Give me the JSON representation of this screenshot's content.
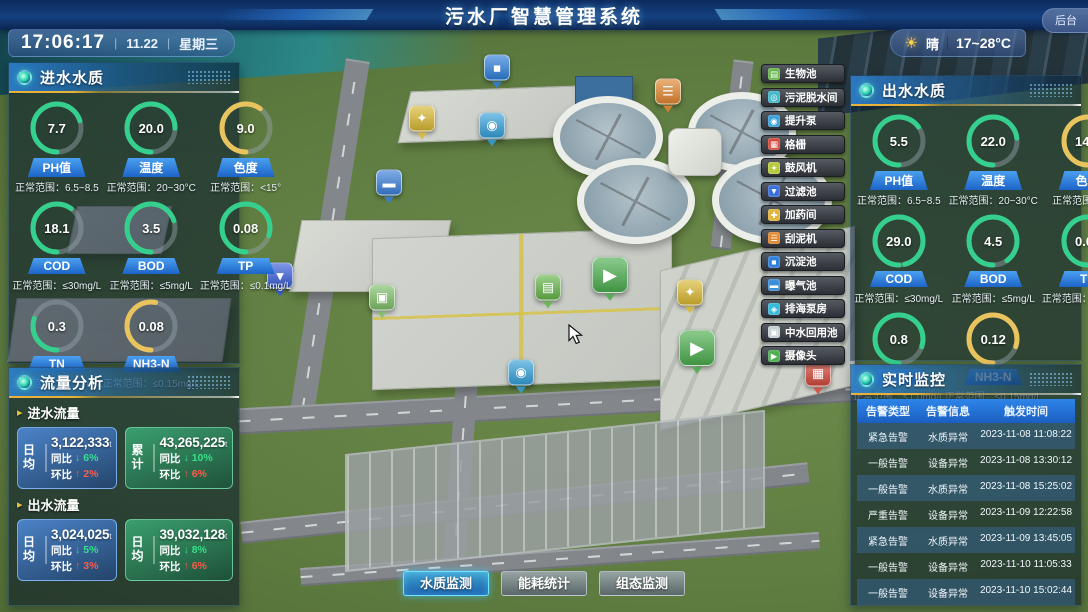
{
  "colors": {
    "green": "#35d08e",
    "yellow": "#e9c45e",
    "gauge_track": "rgba(154,163,173,0.45)",
    "accent_blue": "#2f86d9",
    "header_yellow": "#e8b23a",
    "trend_up_red": "#ff5a4a",
    "trend_down_green": "#35e08a"
  },
  "header": {
    "title": "污水厂智慧管理系统",
    "backstage": "后台"
  },
  "status_bar": {
    "time": "17:06:17",
    "date": "11.22",
    "weekday": "星期三",
    "weather_icon": "☀",
    "weather": "晴",
    "temp_range": "17~28°C"
  },
  "inlet_quality": {
    "title": "进水水质",
    "gauges": [
      {
        "label": "PH值",
        "value": "7.7",
        "range": "正常范围：6.5~8.5",
        "color": "green",
        "frac": 0.7
      },
      {
        "label": "温度",
        "value": "20.0",
        "range": "正常范围：20~30°C",
        "color": "green",
        "frac": 0.75
      },
      {
        "label": "色度",
        "value": "9.0",
        "range": "正常范围：<15°",
        "color": "yellow",
        "frac": 0.6
      },
      {
        "label": "COD",
        "value": "18.1",
        "range": "正常范围：≤30mg/L",
        "color": "green",
        "frac": 0.6
      },
      {
        "label": "BOD",
        "value": "3.5",
        "range": "正常范围：≤5mg/L",
        "color": "green",
        "frac": 0.7
      },
      {
        "label": "TP",
        "value": "0.08",
        "range": "正常范围：≤0.1mg/L",
        "color": "green",
        "frac": 0.8
      },
      {
        "label": "TN",
        "value": "0.3",
        "range": "正常范围：≤1.0mg/L",
        "color": "green",
        "frac": 0.3
      },
      {
        "label": "NH3-N",
        "value": "0.08",
        "range": "正常范围：≤0.15mg/L",
        "color": "yellow",
        "frac": 0.53
      }
    ]
  },
  "outlet_quality": {
    "title": "出水水质",
    "gauges": [
      {
        "label": "PH值",
        "value": "5.5",
        "range": "正常范围：6.5~8.5",
        "color": "green",
        "frac": 0.65
      },
      {
        "label": "温度",
        "value": "22.0",
        "range": "正常范围：20~30°C",
        "color": "green",
        "frac": 0.73
      },
      {
        "label": "色度",
        "value": "14.0",
        "range": "正常范围：<15°",
        "color": "yellow",
        "frac": 0.93
      },
      {
        "label": "COD",
        "value": "29.0",
        "range": "正常范围：≤30mg/L",
        "color": "green",
        "frac": 0.96
      },
      {
        "label": "BOD",
        "value": "4.5",
        "range": "正常范围：≤5mg/L",
        "color": "green",
        "frac": 0.9
      },
      {
        "label": "TP",
        "value": "0.07",
        "range": "正常范围：≤0.1mg/L",
        "color": "green",
        "frac": 0.7
      },
      {
        "label": "TN",
        "value": "0.8",
        "range": "正常范围：≤1.0mg/L",
        "color": "green",
        "frac": 0.8
      },
      {
        "label": "NH3-N",
        "value": "0.12",
        "range": "正常范围：≤0.15mg/L",
        "color": "yellow",
        "frac": 0.8
      }
    ]
  },
  "flow": {
    "title": "流量分析",
    "yoy_label": "同比",
    "mom_label": "环比",
    "down_arrow": "↓",
    "up_arrow": "↑",
    "unit": "t",
    "sections": [
      {
        "label": "进水流量",
        "cards": [
          {
            "tag": "日均",
            "value": "3,122,333",
            "yoy": "6%",
            "mom": "2%",
            "theme": "blue"
          },
          {
            "tag": "累计",
            "value": "43,265,225",
            "yoy": "10%",
            "mom": "6%",
            "theme": "green"
          }
        ]
      },
      {
        "label": "出水流量",
        "cards": [
          {
            "tag": "日均",
            "value": "3,024,025",
            "yoy": "5%",
            "mom": "3%",
            "theme": "blue"
          },
          {
            "tag": "日均",
            "value": "39,032,128",
            "yoy": "8%",
            "mom": "6%",
            "theme": "green"
          }
        ]
      }
    ]
  },
  "monitor": {
    "title": "实时监控",
    "columns": [
      "告警类型",
      "告警信息",
      "触发时间"
    ],
    "rows": [
      {
        "type": "紧急告警",
        "info": "水质异常",
        "time": "2023-11-08 11:08:22"
      },
      {
        "type": "一般告警",
        "info": "设备异常",
        "time": "2023-11-08 13:30:12"
      },
      {
        "type": "一般告警",
        "info": "水质异常",
        "time": "2023-11-08 15:25:02"
      },
      {
        "type": "严重告警",
        "info": "设备异常",
        "time": "2023-11-09 12:22:58"
      },
      {
        "type": "紧急告警",
        "info": "水质异常",
        "time": "2023-11-09 13:45:05"
      },
      {
        "type": "一般告警",
        "info": "设备异常",
        "time": "2023-11-10 11:05:33"
      },
      {
        "type": "一般告警",
        "info": "设备异常",
        "time": "2023-11-10 15:02:44"
      }
    ]
  },
  "map": {
    "legend": [
      {
        "label": "生物池",
        "glyph": "▤",
        "color": "#65b54a"
      },
      {
        "label": "污泥脱水间",
        "glyph": "◎",
        "color": "#3fb6c9"
      },
      {
        "label": "提升泵",
        "glyph": "◉",
        "color": "#35a0d9"
      },
      {
        "label": "格栅",
        "glyph": "▦",
        "color": "#d4483a"
      },
      {
        "label": "鼓风机",
        "glyph": "✦",
        "color": "#b7c93a"
      },
      {
        "label": "过滤池",
        "glyph": "▼",
        "color": "#3a6fd9"
      },
      {
        "label": "加药间",
        "glyph": "✚",
        "color": "#e0b53a"
      },
      {
        "label": "刮泥机",
        "glyph": "☰",
        "color": "#e0862f"
      },
      {
        "label": "沉淀池",
        "glyph": "■",
        "color": "#2f7fd9"
      },
      {
        "label": "曝气池",
        "glyph": "▬",
        "color": "#3a8fd9"
      },
      {
        "label": "排海泵房",
        "glyph": "◈",
        "color": "#35b8d9"
      },
      {
        "label": "中水回用池",
        "glyph": "▣",
        "color": "#c3cdd4"
      },
      {
        "label": "摄像头",
        "glyph": "▶",
        "color": "#4cae4f"
      }
    ],
    "markers": [
      {
        "label": "沉淀池",
        "glyph": "■",
        "color": "#2f7fd9",
        "x": 497,
        "y": 76
      },
      {
        "label": "刮泥机",
        "glyph": "☰",
        "color": "#e0862f",
        "x": 668,
        "y": 100
      },
      {
        "label": "鼓风机",
        "glyph": "✦",
        "color": "#d9b831",
        "x": 422,
        "y": 127
      },
      {
        "label": "提升泵",
        "glyph": "◉",
        "color": "#35a0d9",
        "x": 492,
        "y": 134
      },
      {
        "label": "曝气池",
        "glyph": "▬",
        "color": "#3a7fd9",
        "x": 389,
        "y": 191
      },
      {
        "label": "过滤池",
        "glyph": "▼",
        "color": "#3a5fd9",
        "x": 280,
        "y": 284
      },
      {
        "label": "中水回用池",
        "glyph": "▣",
        "color": "#7fbf6a",
        "x": 382,
        "y": 306
      },
      {
        "label": "生物池",
        "glyph": "▤",
        "color": "#65b54a",
        "x": 548,
        "y": 296
      },
      {
        "label": "摄像头",
        "glyph": "▶",
        "color": "#4cae4f",
        "x": 610,
        "y": 284,
        "big": true
      },
      {
        "label": "鼓风机",
        "glyph": "✦",
        "color": "#d9b831",
        "x": 690,
        "y": 301
      },
      {
        "label": "摄像头",
        "glyph": "▶",
        "color": "#4cae4f",
        "x": 697,
        "y": 357,
        "big": true
      },
      {
        "label": "格栅",
        "glyph": "▦",
        "color": "#d4483a",
        "x": 818,
        "y": 382
      },
      {
        "label": "提升泵",
        "glyph": "◉",
        "color": "#35a0d9",
        "x": 521,
        "y": 381
      }
    ]
  },
  "bottom": {
    "buttons": [
      {
        "label": "水质监测",
        "active": true
      },
      {
        "label": "能耗统计",
        "active": false
      },
      {
        "label": "组态监测",
        "active": false
      }
    ]
  }
}
